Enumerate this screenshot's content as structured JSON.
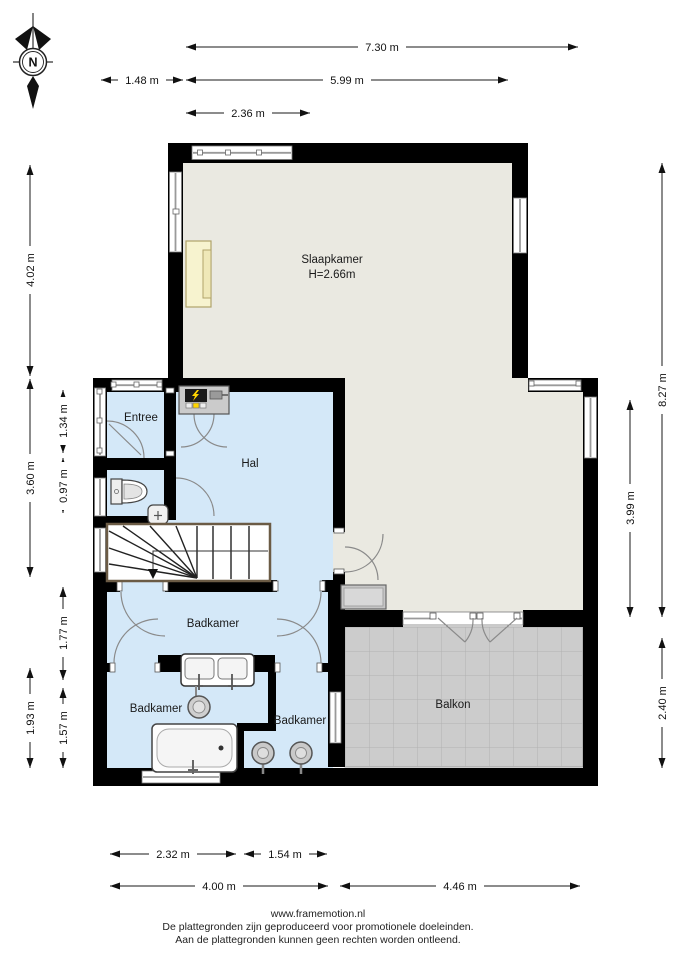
{
  "page": {
    "background": "#ffffff"
  },
  "compass": {
    "label": "N"
  },
  "plan": {
    "rooms": {
      "slaapkamer": {
        "label": "Slaapkamer",
        "ceiling_height": "H=2.66m"
      },
      "entree": {
        "label": "Entree"
      },
      "hal": {
        "label": "Hal"
      },
      "badkamer_main": {
        "label": "Badkamer"
      },
      "badkamer_links": {
        "label": "Badkamer"
      },
      "badkamer_rechts": {
        "label": "Badkamer"
      },
      "balkon": {
        "label": "Balkon"
      }
    },
    "colors": {
      "wall": "#000000",
      "interior_blue": "#d4e8f8",
      "interior_beige": "#eae9e1",
      "balcony_gray": "#cccccc",
      "bed_cream": "#f7f3cf",
      "electric_yellow": "#ffd500"
    }
  },
  "dimensions": {
    "top": {
      "full_width": "7.30 m",
      "left_offset": "1.48 m",
      "bedroom_width": "5.99 m",
      "window_width": "2.36 m"
    },
    "left": {
      "bedroom_height": "4.02 m",
      "mid_height": "3.60 m",
      "entree_height": "1.34 m",
      "toilet_height": "0.97 m",
      "bathroom_height": "1.77 m",
      "lower_height": "1.93 m",
      "bath_lower_height": "1.57 m"
    },
    "right": {
      "total_height": "8.27 m",
      "bedroom_right_height": "3.99 m",
      "balcony_height": "2.40 m"
    },
    "bottom": {
      "bath_left_width": "2.32 m",
      "bath_right_width": "1.54 m",
      "wing_width": "4.00 m",
      "balcony_width": "4.46 m"
    }
  },
  "footer": {
    "website": "www.framemotion.nl",
    "disclaimer_line1": "De plattegronden zijn geproduceerd voor promotionele doeleinden.",
    "disclaimer_line2": "Aan de plattegronden kunnen geen rechten worden ontleend."
  }
}
